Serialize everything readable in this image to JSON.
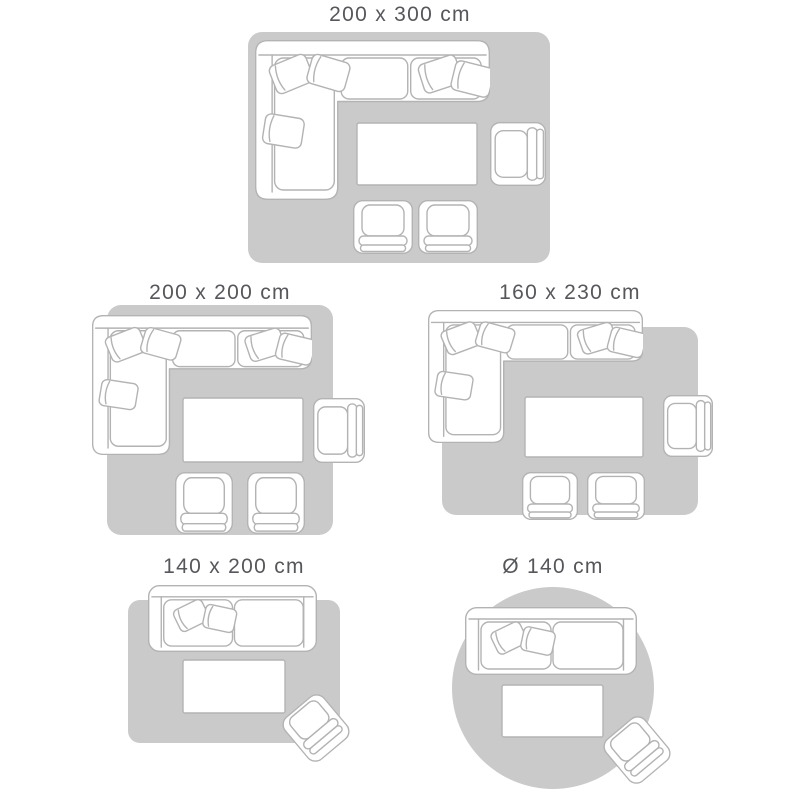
{
  "colors": {
    "background": "#ffffff",
    "rug_fill": "#cacaca",
    "furniture_fill": "#ffffff",
    "furniture_outline": "#b3b3b3",
    "label_text": "#56575b"
  },
  "panels": [
    {
      "label": "200 x 300 cm",
      "rug_shape": "rectangle",
      "furniture": [
        "corner-sofa",
        "coffee-table",
        "side-armchair",
        "front-armchair",
        "front-armchair"
      ]
    },
    {
      "label": "200 x 200 cm",
      "rug_shape": "square",
      "furniture": [
        "corner-sofa",
        "coffee-table",
        "side-armchair",
        "front-armchair",
        "front-armchair"
      ]
    },
    {
      "label": "160 x 230 cm",
      "rug_shape": "rectangle",
      "furniture": [
        "corner-sofa",
        "coffee-table",
        "side-armchair",
        "front-armchair",
        "front-armchair"
      ]
    },
    {
      "label": "140 x 200 cm",
      "rug_shape": "rectangle",
      "furniture": [
        "two-seat-sofa",
        "coffee-table",
        "rotated-armchair"
      ]
    },
    {
      "label": "Ø 140 cm",
      "rug_shape": "circle",
      "furniture": [
        "two-seat-sofa",
        "coffee-table",
        "rotated-armchair"
      ]
    }
  ]
}
